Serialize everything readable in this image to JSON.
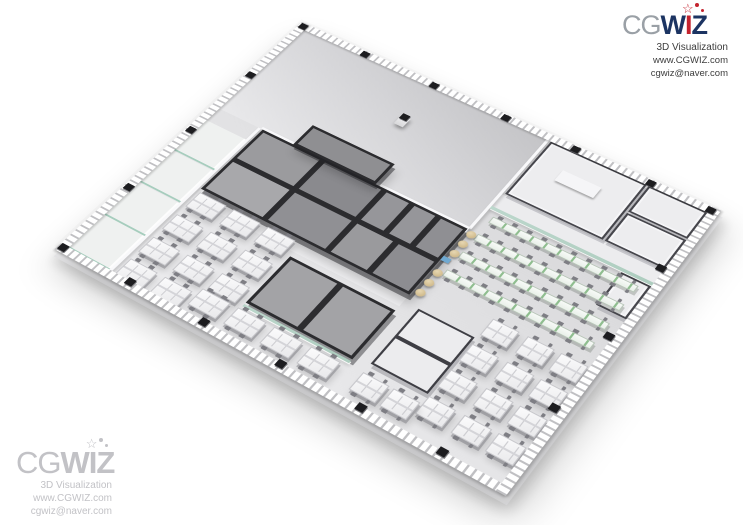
{
  "header": {
    "cg": "CG",
    "wiz_w": "W",
    "wiz_i": "I",
    "wiz_z": "Z",
    "tagline": "3D Visualization",
    "website": "www.CGWIZ.com",
    "email": "cgwiz@naver.com"
  },
  "watermark": {
    "cg": "CG",
    "wiz_w": "W",
    "wiz_i": "I",
    "wiz_z": "Z",
    "tagline": "3D Visualization",
    "website": "www.CGWIZ.com",
    "email": "cgwiz@naver.com"
  },
  "icons": {
    "wand_star": "☆"
  },
  "colors": {
    "logo_gray": "#9aa0a6",
    "logo_navy": "#1c3462",
    "logo_red": "#c4232e",
    "watermark_gray": "#c2c2c6",
    "glass_green": "#bcd7cc",
    "wood_brown": "#96805e",
    "accent_orange": "#e0a14e",
    "table_green": "#8fbe8f"
  }
}
